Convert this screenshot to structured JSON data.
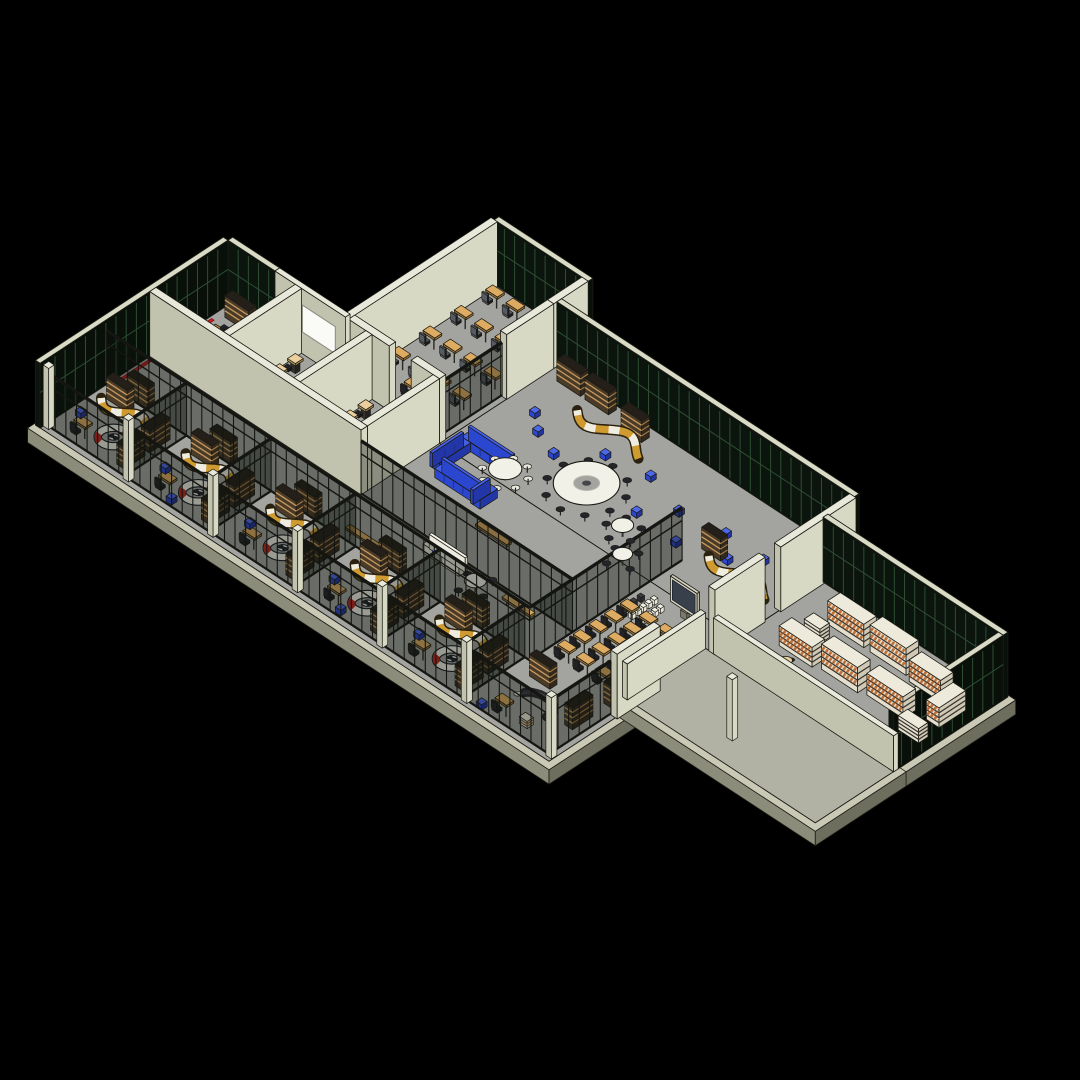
{
  "view": {
    "width": 1080,
    "height": 1080,
    "background": "#000000",
    "title": "isometric building floor plan 3d view"
  },
  "projection": {
    "ox": 228,
    "oy": 305,
    "ax": 0.783,
    "ay": 0.513,
    "kz": 0.9,
    "wallHeight": 72,
    "glassHeight": 72,
    "storeHeight": 60,
    "lowWallHeight": 40
  },
  "palette": {
    "bg": "#000000",
    "floor": "#a3a3a0",
    "plaza": "#b2b2a4",
    "slabTop": "#c9c9b6",
    "slabS": "#8c8c7a",
    "slabE": "#6e6e5e",
    "wallTop": "#e8e9da",
    "wallS": "#c2c3ae",
    "wallE": "#d8d9c4",
    "glassFace": "#0c150d",
    "glassFaceE": "#091009",
    "glassMull": "#2e4d33",
    "glassTop": "#dadbc6",
    "storeGlass": "rgba(14,18,14,0.38)",
    "storeFrame": "#151612",
    "shelfBody": "#4a3b28",
    "shelfBodyE": "#33281c",
    "shelfLine": "#c89a5e",
    "shelfTop": "#241f18",
    "stackFace": "#e3decd",
    "stackFaceE": "#cfc9b6",
    "stackTop": "#edeadb",
    "stackLine": "#35302a",
    "stackBooks": "#bf7038",
    "deskTop": "#ddab62",
    "deskSide": "#9a7338",
    "chair": "#222228",
    "officeChair": "#565a62",
    "stoolTop": "#eccf9c",
    "stoolBase": "#33312c",
    "tableWhite": "#f2f1e8",
    "tableBrown": "#bd8746",
    "tableBrownSide": "#82592a",
    "blue": "#2b46cf",
    "blueTop": "#4560e8",
    "whiteSofa": "#eceade",
    "whiteSofaTop": "#f6f4ea",
    "snakeGold": "#cf9a30",
    "snakeWhite": "#efece0",
    "snakeOutline": "#2a220f",
    "ringSeatWhite": "#f1efe6",
    "ringSeatRed": "#c1251d",
    "ringSeatDark": "#1c2026",
    "tvFrame": "#d6d3c0",
    "tvScreen": "#38404b",
    "tvSide": "#b4b2a0",
    "benchTop": "#d9a760",
    "benchSide": "#8a6a38",
    "red": "#c01d1d",
    "whiteboard": "#fafaf6",
    "outline": "#1b1b14",
    "basket": "#e5dcc8",
    "basketLine": "#7a5a34",
    "darkSofa": "#26262b"
  },
  "scene": {
    "floors": [
      {
        "u": 0,
        "v": 0,
        "w": 650,
        "d": 240,
        "c": "floor"
      },
      {
        "u": 150,
        "v": -190,
        "w": 120,
        "d": 190,
        "c": "floor"
      },
      {
        "u": 270,
        "v": -150,
        "w": 380,
        "d": 150,
        "c": "floor"
      },
      {
        "u": 650,
        "v": -110,
        "w": 230,
        "d": 140,
        "c": "floor"
      },
      {
        "u": 640,
        "v": 30,
        "w": 240,
        "d": 100,
        "c": "plaza"
      }
    ],
    "objects": [
      {
        "t": "glass",
        "u": 150,
        "v": -196,
        "w": 120,
        "d": 6
      },
      {
        "t": "wall",
        "u": 146,
        "v": -190,
        "w": 8,
        "d": 190
      },
      {
        "t": "ocg",
        "u": 162,
        "v": -176,
        "cols": 4,
        "rows": 4,
        "du": 26,
        "dv": 40
      },
      {
        "t": "dk",
        "u": 200,
        "v": -34
      },
      {
        "t": "wall",
        "u": 262,
        "v": -190,
        "w": 8,
        "d": 44
      },
      {
        "t": "wall",
        "u": 262,
        "v": -146,
        "w": 8,
        "d": 60
      },
      {
        "t": "sfv",
        "u": 264,
        "v": -86,
        "dv": 82
      },
      {
        "t": "wall",
        "u": 154,
        "v": -8,
        "w": 52,
        "d": 8
      },
      {
        "t": "wall",
        "u": 234,
        "v": -8,
        "w": 36,
        "d": 8
      },
      {
        "t": "glass",
        "u": 0,
        "v": -6,
        "w": 60,
        "d": 6
      },
      {
        "t": "wall",
        "u": 60,
        "v": -6,
        "w": 90,
        "d": 6
      },
      {
        "t": "wb",
        "u": 95,
        "w": 42,
        "vf": 0
      },
      {
        "t": "glass",
        "u": -6,
        "v": 0,
        "w": 6,
        "d": 240
      },
      {
        "t": "strip",
        "u": 3,
        "v": 24,
        "len": 120
      },
      {
        "t": "sh",
        "u": 10,
        "v": 4,
        "w": 30,
        "d": 10
      },
      {
        "t": "sh",
        "u": 44,
        "v": 4,
        "w": 28,
        "d": 10
      },
      {
        "t": "tb",
        "u": 22,
        "v": 38,
        "w": 44,
        "d": 22
      },
      {
        "t": "bl",
        "u": 12,
        "v": 70
      },
      {
        "t": "bl",
        "u": 24,
        "v": 76
      },
      {
        "t": "sh",
        "u": 64,
        "v": 66,
        "w": 10,
        "d": 20
      },
      {
        "t": "wall",
        "u": 86,
        "v": 0,
        "w": 8,
        "d": 92
      },
      {
        "t": "sqg",
        "u": 102,
        "v": 16,
        "cols": 3,
        "rows": 4,
        "du": 24,
        "dv": 20
      },
      {
        "t": "wall",
        "u": 176,
        "v": 0,
        "w": 8,
        "d": 92
      },
      {
        "t": "sqg",
        "u": 192,
        "v": 16,
        "cols": 3,
        "rows": 4,
        "du": 24,
        "dv": 20
      },
      {
        "t": "wall",
        "u": 262,
        "v": 0,
        "w": 8,
        "d": 92
      },
      {
        "t": "wall",
        "u": 0,
        "v": 92,
        "w": 270,
        "d": 8
      },
      {
        "t": "glass",
        "u": 270,
        "v": -156,
        "w": 380,
        "d": 6
      },
      {
        "t": "sh",
        "u": 284,
        "v": -146,
        "w": 30,
        "d": 10
      },
      {
        "t": "sh",
        "u": 320,
        "v": -146,
        "w": 30,
        "d": 10
      },
      {
        "t": "sh",
        "u": 372,
        "v": -140,
        "w": 26,
        "d": 10
      },
      {
        "t": "sn",
        "u": 330,
        "v": -116,
        "L": 86,
        "amp": 10
      },
      {
        "t": "psf",
        "u": 300,
        "v": -92
      },
      {
        "t": "psf",
        "u": 320,
        "v": -76
      },
      {
        "t": "psf",
        "u": 352,
        "v": -64
      },
      {
        "t": "psf",
        "u": 386,
        "v": -96
      },
      {
        "t": "psf",
        "u": 414,
        "v": -68
      },
      {
        "t": "psf",
        "u": 436,
        "v": -104
      },
      {
        "t": "psf",
        "u": 462,
        "v": -60
      },
      {
        "t": "psf",
        "u": 488,
        "v": -88
      },
      {
        "t": "psf",
        "u": 516,
        "v": -56
      },
      {
        "t": "psf",
        "u": 540,
        "v": -96
      },
      {
        "t": "psf",
        "u": 566,
        "v": -72
      },
      {
        "t": "psf",
        "u": 590,
        "v": -94
      },
      {
        "t": "psf",
        "u": 616,
        "v": -62
      },
      {
        "t": "psf",
        "u": 634,
        "v": -108
      },
      {
        "t": "sh",
        "u": 540,
        "v": -74,
        "w": 24,
        "d": 9
      },
      {
        "t": "sn",
        "u": 556,
        "v": -58,
        "L": 78,
        "amp": 9
      },
      {
        "t": "sh",
        "u": 608,
        "v": -44,
        "w": 22,
        "d": 9
      },
      {
        "t": "sfw",
        "u": 540,
        "v": -40,
        "dv": 195
      },
      {
        "t": "tv",
        "u": 580,
        "v": 12,
        "len": 34
      },
      {
        "t": "strow",
        "u": 560,
        "v": 16,
        "n": 5,
        "dv": 7,
        "c": "lt"
      },
      {
        "t": "strow",
        "u": 572,
        "v": 20,
        "n": 4,
        "dv": 7,
        "c": "lt"
      },
      {
        "t": "strow",
        "u": 549,
        "v": 22,
        "n": 3,
        "dv": 9,
        "c": "dk"
      },
      {
        "t": "dkg",
        "u": 554,
        "v": 44,
        "cols": 4,
        "rows": 5,
        "du": 24,
        "dv": 20
      },
      {
        "t": "sh",
        "u": 628,
        "v": 126,
        "w": 10,
        "d": 22
      },
      {
        "t": "sf",
        "u": 286,
        "v": -24,
        "w": 56,
        "d": 12,
        "c": "blue"
      },
      {
        "t": "sf",
        "u": 286,
        "v": -12,
        "w": 12,
        "d": 40,
        "c": "blue"
      },
      {
        "t": "rt",
        "u": 348,
        "v": -6,
        "R": 15,
        "n": 8,
        "cc": "white"
      },
      {
        "t": "ringt",
        "u": 414,
        "v": -44
      },
      {
        "t": "rt",
        "u": 478,
        "v": -26,
        "R": 10,
        "n": 5
      },
      {
        "t": "rt",
        "u": 506,
        "v": 2,
        "R": 9,
        "n": 4
      },
      {
        "t": "sf",
        "u": 300,
        "v": 24,
        "w": 48,
        "d": 12,
        "c": "blue"
      },
      {
        "t": "sf",
        "u": 348,
        "v": 16,
        "w": 12,
        "d": 22,
        "c": "blue"
      },
      {
        "t": "bn",
        "u": 380,
        "v": 58,
        "w": 40
      },
      {
        "t": "sfu",
        "u": 270,
        "v": 100,
        "dw": 270
      },
      {
        "t": "sf",
        "u": 366,
        "v": 106,
        "w": 46,
        "d": 11,
        "c": "white"
      },
      {
        "t": "rt",
        "u": 438,
        "v": 122,
        "R": 10,
        "n": 4
      },
      {
        "t": "bn",
        "u": 300,
        "v": 144,
        "w": 40
      },
      {
        "t": "bn",
        "u": 468,
        "v": 112,
        "w": 36
      },
      {
        "t": "sh",
        "u": 24,
        "v": 144,
        "w": 26,
        "d": 9
      },
      {
        "t": "sh",
        "u": 130,
        "v": 144,
        "w": 26,
        "d": 9
      },
      {
        "t": "sh",
        "u": 238,
        "v": 144,
        "w": 26,
        "d": 9
      },
      {
        "t": "sh",
        "u": 346,
        "v": 144,
        "w": 26,
        "d": 9
      },
      {
        "t": "sh",
        "u": 452,
        "v": 144,
        "w": 26,
        "d": 9
      },
      {
        "t": "wall",
        "u": 644,
        "v": -150,
        "w": 8,
        "d": 96
      },
      {
        "t": "wall",
        "u": 644,
        "v": -34,
        "w": 8,
        "d": 64
      },
      {
        "t": "wall",
        "u": 644,
        "v": 100,
        "w": 8,
        "d": 55
      },
      {
        "t": "glass",
        "u": 650,
        "v": -116,
        "w": 230,
        "d": 6
      },
      {
        "t": "glass",
        "u": 874,
        "v": -110,
        "w": 6,
        "d": 140
      },
      {
        "t": "stk",
        "u": 694,
        "v": -88,
        "w": 46,
        "d": 16,
        "h": 26
      },
      {
        "t": "stk",
        "u": 748,
        "v": -88,
        "w": 46,
        "d": 16,
        "h": 30
      },
      {
        "t": "stk",
        "u": 802,
        "v": -84,
        "w": 40,
        "d": 16,
        "h": 24
      },
      {
        "t": "stk",
        "u": 850,
        "v": -76,
        "w": 16,
        "d": 34,
        "h": 22
      },
      {
        "t": "stk",
        "u": 688,
        "v": -60,
        "w": 20,
        "d": 12,
        "h": 16,
        "plain": 1
      },
      {
        "t": "stk",
        "u": 684,
        "v": -36,
        "w": 42,
        "d": 16,
        "h": 22
      },
      {
        "t": "stk",
        "u": 734,
        "v": -40,
        "w": 46,
        "d": 16,
        "h": 28
      },
      {
        "t": "stk",
        "u": 788,
        "v": -44,
        "w": 46,
        "d": 16,
        "h": 24
      },
      {
        "t": "stk",
        "u": 842,
        "v": -26,
        "w": 26,
        "d": 12,
        "h": 16,
        "plain": 1
      },
      {
        "t": "cf",
        "u": 700,
        "v": 14
      },
      {
        "t": "cf",
        "u": 724,
        "v": 20
      },
      {
        "t": "cf",
        "u": 712,
        "v": 0
      },
      {
        "t": "lowwall",
        "u": 650,
        "v": 24,
        "w": 230,
        "d": 6
      },
      {
        "t": "lowwall",
        "u": 634,
        "v": 30,
        "w": 6,
        "d": 100
      },
      {
        "t": "post",
        "u": 740,
        "v": 96
      },
      {
        "t": "sfu",
        "u": 0,
        "v": 155,
        "dw": 540
      },
      {
        "t": "sh",
        "u": 14,
        "v": 160,
        "w": 26,
        "d": 9
      },
      {
        "t": "sn",
        "u": 14,
        "v": 176,
        "L": 66,
        "amp": 8
      },
      {
        "t": "rs",
        "u": 60,
        "v": 206
      },
      {
        "t": "sh",
        "u": 84,
        "v": 168,
        "w": 10,
        "d": 26
      },
      {
        "t": "sh",
        "u": 84,
        "v": 200,
        "w": 10,
        "d": 26
      },
      {
        "t": "dk",
        "u": 26,
        "v": 214
      },
      {
        "t": "psf",
        "u": 10,
        "v": 198
      },
      {
        "t": "sfv",
        "u": 102,
        "v": 155,
        "dv": 79
      },
      {
        "t": "sh",
        "u": 122,
        "v": 160,
        "w": 26,
        "d": 9
      },
      {
        "t": "sn",
        "u": 122,
        "v": 176,
        "L": 66,
        "amp": 8
      },
      {
        "t": "rs",
        "u": 168,
        "v": 206
      },
      {
        "t": "sh",
        "u": 192,
        "v": 168,
        "w": 10,
        "d": 26
      },
      {
        "t": "sh",
        "u": 192,
        "v": 200,
        "w": 10,
        "d": 26
      },
      {
        "t": "dk",
        "u": 134,
        "v": 214
      },
      {
        "t": "psf",
        "u": 118,
        "v": 198
      },
      {
        "t": "psf",
        "u": 152,
        "v": 224
      },
      {
        "t": "sfv",
        "u": 210,
        "v": 155,
        "dv": 79
      },
      {
        "t": "sh",
        "u": 230,
        "v": 160,
        "w": 26,
        "d": 9
      },
      {
        "t": "sn",
        "u": 230,
        "v": 176,
        "L": 66,
        "amp": 8
      },
      {
        "t": "rs",
        "u": 276,
        "v": 206
      },
      {
        "t": "sh",
        "u": 300,
        "v": 168,
        "w": 10,
        "d": 26
      },
      {
        "t": "sh",
        "u": 300,
        "v": 200,
        "w": 10,
        "d": 26
      },
      {
        "t": "dk",
        "u": 242,
        "v": 214
      },
      {
        "t": "psf",
        "u": 226,
        "v": 198
      },
      {
        "t": "sfv",
        "u": 318,
        "v": 155,
        "dv": 79
      },
      {
        "t": "sh",
        "u": 338,
        "v": 160,
        "w": 26,
        "d": 9
      },
      {
        "t": "sn",
        "u": 338,
        "v": 176,
        "L": 66,
        "amp": 8
      },
      {
        "t": "rs",
        "u": 384,
        "v": 206
      },
      {
        "t": "sh",
        "u": 408,
        "v": 168,
        "w": 10,
        "d": 26
      },
      {
        "t": "sh",
        "u": 408,
        "v": 200,
        "w": 10,
        "d": 26
      },
      {
        "t": "dk",
        "u": 350,
        "v": 214
      },
      {
        "t": "psf",
        "u": 334,
        "v": 198
      },
      {
        "t": "psf",
        "u": 368,
        "v": 224
      },
      {
        "t": "sfv",
        "u": 426,
        "v": 155,
        "dv": 79
      },
      {
        "t": "sh",
        "u": 446,
        "v": 160,
        "w": 26,
        "d": 9
      },
      {
        "t": "sn",
        "u": 446,
        "v": 176,
        "L": 66,
        "amp": 8
      },
      {
        "t": "rs",
        "u": 492,
        "v": 206
      },
      {
        "t": "sh",
        "u": 516,
        "v": 168,
        "w": 10,
        "d": 26
      },
      {
        "t": "sh",
        "u": 516,
        "v": 200,
        "w": 10,
        "d": 26
      },
      {
        "t": "dk",
        "u": 458,
        "v": 214
      },
      {
        "t": "psf",
        "u": 442,
        "v": 198
      },
      {
        "t": "sfv",
        "u": 534,
        "v": 155,
        "dv": 79
      },
      {
        "t": "sh",
        "u": 554,
        "v": 160,
        "w": 26,
        "d": 9
      },
      {
        "t": "arc",
        "u": 590,
        "v": 198
      },
      {
        "t": "bsk",
        "u": 594,
        "v": 214
      },
      {
        "t": "sh",
        "u": 624,
        "v": 168,
        "w": 10,
        "d": 26
      },
      {
        "t": "dk",
        "u": 566,
        "v": 216
      },
      {
        "t": "psf",
        "u": 550,
        "v": 226
      },
      {
        "t": "sfv",
        "u": 644,
        "v": 155,
        "dv": 79
      },
      {
        "t": "sfu",
        "u": 0,
        "v": 234,
        "dw": 650
      },
      {
        "t": "post",
        "u": 0,
        "v": 229
      },
      {
        "t": "post",
        "u": 102,
        "v": 229
      },
      {
        "t": "post",
        "u": 210,
        "v": 229
      },
      {
        "t": "post",
        "u": 318,
        "v": 229
      },
      {
        "t": "post",
        "u": 426,
        "v": 229
      },
      {
        "t": "post",
        "u": 534,
        "v": 229
      },
      {
        "t": "post",
        "u": 642,
        "v": 229
      }
    ]
  }
}
